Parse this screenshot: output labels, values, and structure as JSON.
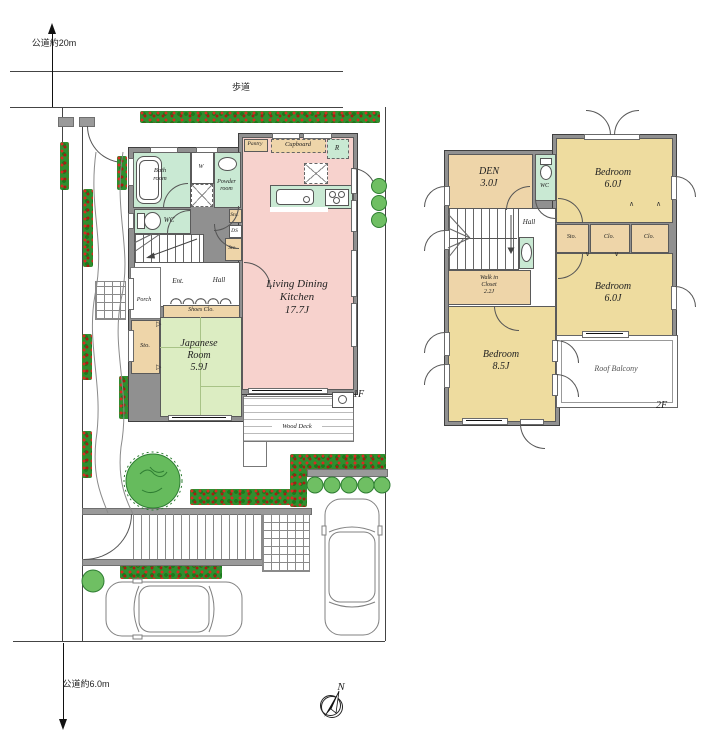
{
  "colors": {
    "wall": "#909090",
    "ldk": "#f7d2cd",
    "tatami": "#dcedc2",
    "bedroom": "#eedc9f",
    "wet": "#c9e9d3",
    "tan": "#eed5a9",
    "hedge": "#2f8f2f",
    "tree": "#66bb5d"
  },
  "site": {
    "road_top_name": "公道",
    "road_top_width": "約20m",
    "sidewalk": "歩道",
    "road_bottom_name": "公道",
    "road_bottom_width": "約6.0m",
    "compass_north": "N"
  },
  "icons": {
    "fold_up": "∧",
    "fold_down": "∨",
    "slide": "▷"
  },
  "floor1": {
    "floor_label": "1F",
    "ldk_line1": "Living Dining",
    "ldk_line2": "Kitchen",
    "ldk_area": "17.7J",
    "japanese_line1": "Japanese",
    "japanese_line2": "Room",
    "japanese_area": "5.9J",
    "bath_line1": "Bath",
    "bath_line2": "room",
    "powder_line1": "Powder",
    "powder_line2": "room",
    "wc": "WC",
    "washer": "W",
    "duct": "DS",
    "storage": "Sto.",
    "pantry": "Pantry",
    "cupboard": "Cupboard",
    "refrigerator": "R",
    "entrance": "Ent.",
    "hall": "Hall",
    "porch": "Porch",
    "shoes_closet": "Shoes Clo.",
    "wood_deck": "Wood Deck"
  },
  "floor2": {
    "floor_label": "2F",
    "den_name": "DEN",
    "den_area": "3.0J",
    "wc": "WC",
    "hall": "Hall",
    "bedroom_name": "Bedroom",
    "bedroom_area_small": "6.0J",
    "bedroom_area_large": "8.5J",
    "storage": "Sto.",
    "closet": "Clo.",
    "wic_line1": "Walk in",
    "wic_line2": "Closet",
    "wic_area": "2.2J",
    "roof_balcony": "Roof Balcony"
  }
}
